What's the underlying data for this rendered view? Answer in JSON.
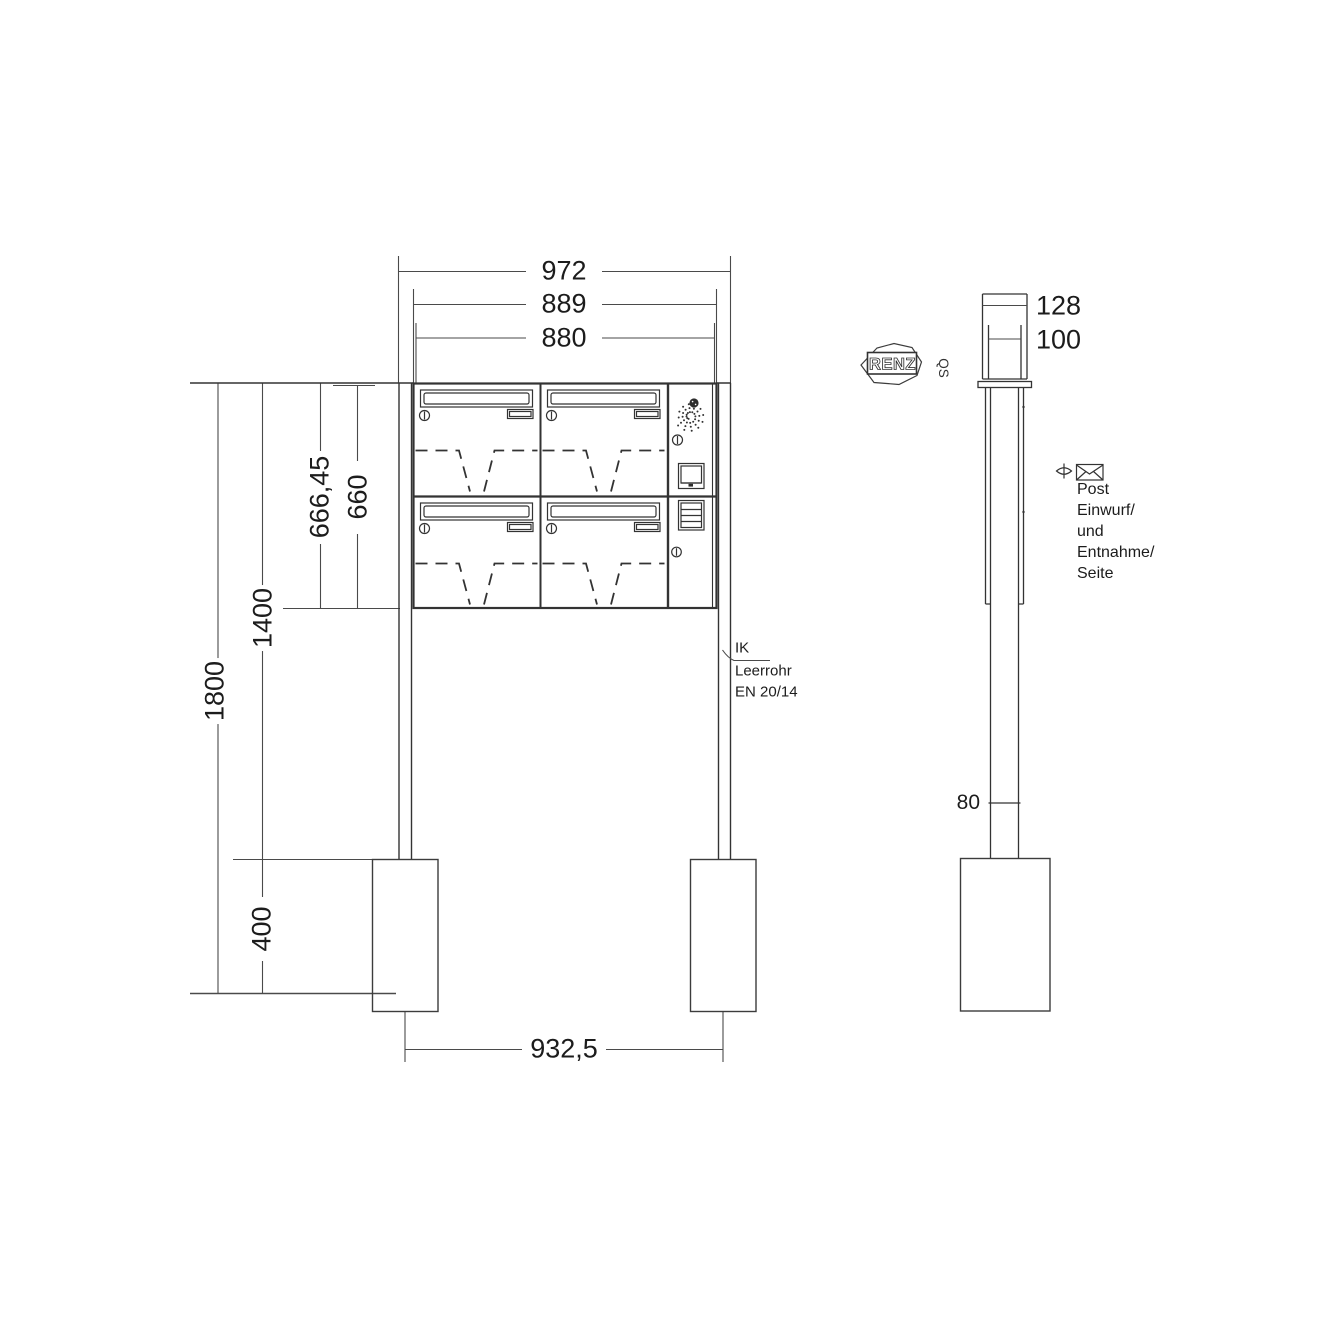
{
  "front": {
    "dims": {
      "overall_width": "972",
      "trim_width": "889",
      "body_width": "880",
      "trim_height": "666,45",
      "body_height": "660",
      "top_to_foundation": "1400",
      "total_height": "1800",
      "foundation_depth": "400",
      "anchor_spacing": "932,5"
    },
    "conduit_note": {
      "l1": "IK",
      "l2": "Leerrohr",
      "l3": "EN 20/14"
    }
  },
  "side": {
    "dims": {
      "overall_depth": "128",
      "body_depth": "100",
      "conduit_height": "80"
    },
    "access_note": {
      "l1": "Post",
      "l2": "Einwurf/",
      "l3": "und",
      "l4": "Entnahme/",
      "l5": "Seite"
    }
  },
  "brand": {
    "logo": "RENZ",
    "qs": "QS"
  },
  "colors": {
    "line": "#333333",
    "dim_line": "#4a4a4a",
    "text": "#1c1c1c"
  }
}
